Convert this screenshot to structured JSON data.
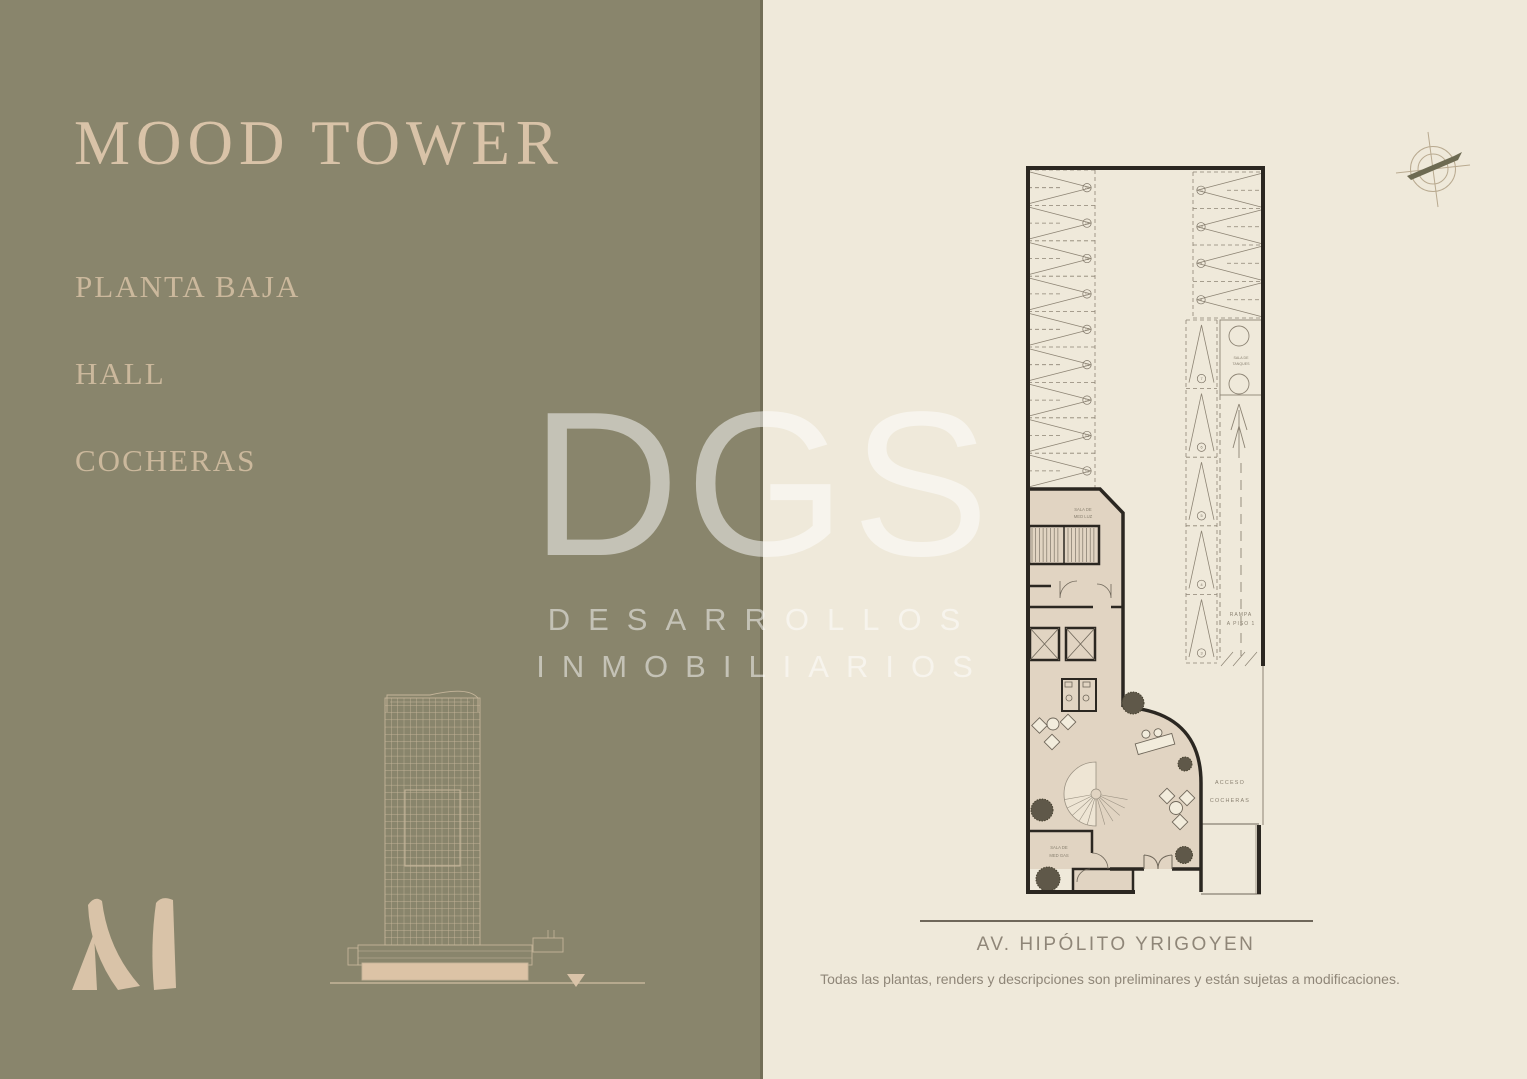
{
  "colors": {
    "olive_panel": "#89856c",
    "cream_panel": "#efe9da",
    "beige_accent": "#d9c3a8",
    "menu_text": "#cbb89c",
    "plan_wall": "#2b2721",
    "plan_tan_fill": "#e1d4c2",
    "plan_line_gray": "#8d8474",
    "footer_text": "#8f8678",
    "watermark": "rgba(255,255,255,0.5)"
  },
  "left_panel": {
    "title": "MOOD TOWER",
    "menu": [
      {
        "label": "PLANTA BAJA"
      },
      {
        "label": "HALL"
      },
      {
        "label": "COCHERAS"
      }
    ]
  },
  "watermark": {
    "logo": "DGS",
    "line1": "DESARROLLOS",
    "line2": "INMOBILIARIOS"
  },
  "icons": {
    "compass": "compass-rose",
    "floor_marker": "down-triangle"
  },
  "plan": {
    "labels": {
      "sala_tanques": [
        "SALA DE",
        "TANQUES"
      ],
      "rampa": [
        "RAMPA",
        "A PISO 1"
      ],
      "sala_med_luz": [
        "SALA DE",
        "MED LUZ"
      ],
      "sala_med_gas": [
        "SALA DE",
        "MED GAS"
      ],
      "acceso": [
        "ACCESO",
        "COCHERAS"
      ]
    },
    "parking_groups": [
      {
        "dir": "right",
        "x": 13,
        "w": 67,
        "y": 12,
        "h": 35.4,
        "count": 9,
        "numbers": [
          "20",
          "19",
          "18",
          "17",
          "16",
          "15",
          "14",
          "13",
          "12"
        ]
      },
      {
        "dir": "left",
        "x": 178,
        "w": 68,
        "y": 14,
        "h": 36.5,
        "count": 4,
        "numbers": [
          "11",
          "10",
          "9",
          "8"
        ]
      },
      {
        "dir": "up",
        "x": 171,
        "w": 31,
        "y": 162,
        "h": 68.6,
        "count": 5,
        "numbers": [
          "7",
          "6",
          "5",
          "4",
          "3"
        ]
      }
    ]
  },
  "footer": {
    "street": "AV. HIPÓLITO YRIGOYEN",
    "disclaimer": "Todas las plantas, renders y descripciones son preliminares y están sujetas a modificaciones."
  }
}
